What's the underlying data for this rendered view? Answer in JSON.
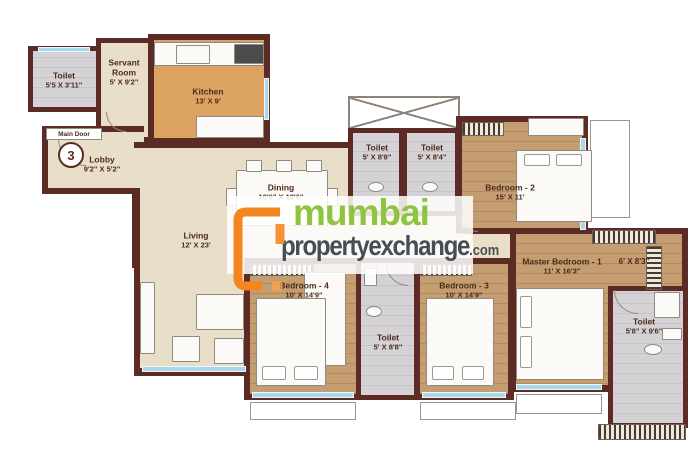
{
  "watermark": {
    "brand_line1": "mumbai",
    "brand_line2": "propertyexchange",
    "brand_suffix": ".com",
    "color_green": "#8fc43e",
    "color_dark": "#454d55",
    "color_orange": "#f5861f"
  },
  "door": {
    "label": "Main Door",
    "number": "3"
  },
  "passage": {
    "label": "3'6\" wide Passage"
  },
  "colors": {
    "wall": "#5d2b26",
    "floor_beige": "#e9dfc9",
    "floor_wood": "#c49e70",
    "floor_kitchen": "#dca262",
    "window": "#a9d9e9"
  },
  "rooms": {
    "toilet_servant": {
      "name": "Toilet",
      "dims": "5'5 X 3'11\""
    },
    "servant": {
      "name": "Servant Room",
      "dims": "5' X 9'2\""
    },
    "kitchen": {
      "name": "Kitchen",
      "dims": "13' X 9'"
    },
    "lobby": {
      "name": "Lobby",
      "dims": "9'2\" X 5'2\""
    },
    "living": {
      "name": "Living",
      "dims": "12' X 23'"
    },
    "dining": {
      "name": "Dining",
      "dims": "10'6\" X 12'6\""
    },
    "toilet_a": {
      "name": "Toilet",
      "dims": "5' X 8'8\""
    },
    "toilet_b": {
      "name": "Toilet",
      "dims": "5' X 8'4\""
    },
    "bedroom2": {
      "name": "Bedroom - 2",
      "dims": "15' X 11'"
    },
    "master": {
      "name": "Master Bedroom - 1",
      "dims": "11' X 16'3\""
    },
    "dressing": {
      "dims": "6' X 8'3\""
    },
    "toilet_master": {
      "name": "Toilet",
      "dims": "5'8\" X 9'6\""
    },
    "bedroom4": {
      "name": "Bedroom - 4",
      "dims": "10' X 14'9\""
    },
    "bedroom3": {
      "name": "Bedroom - 3",
      "dims": "10' X 14'9\""
    },
    "toilet_c": {
      "name": "Toilet",
      "dims": "5' X 8'8\""
    }
  }
}
